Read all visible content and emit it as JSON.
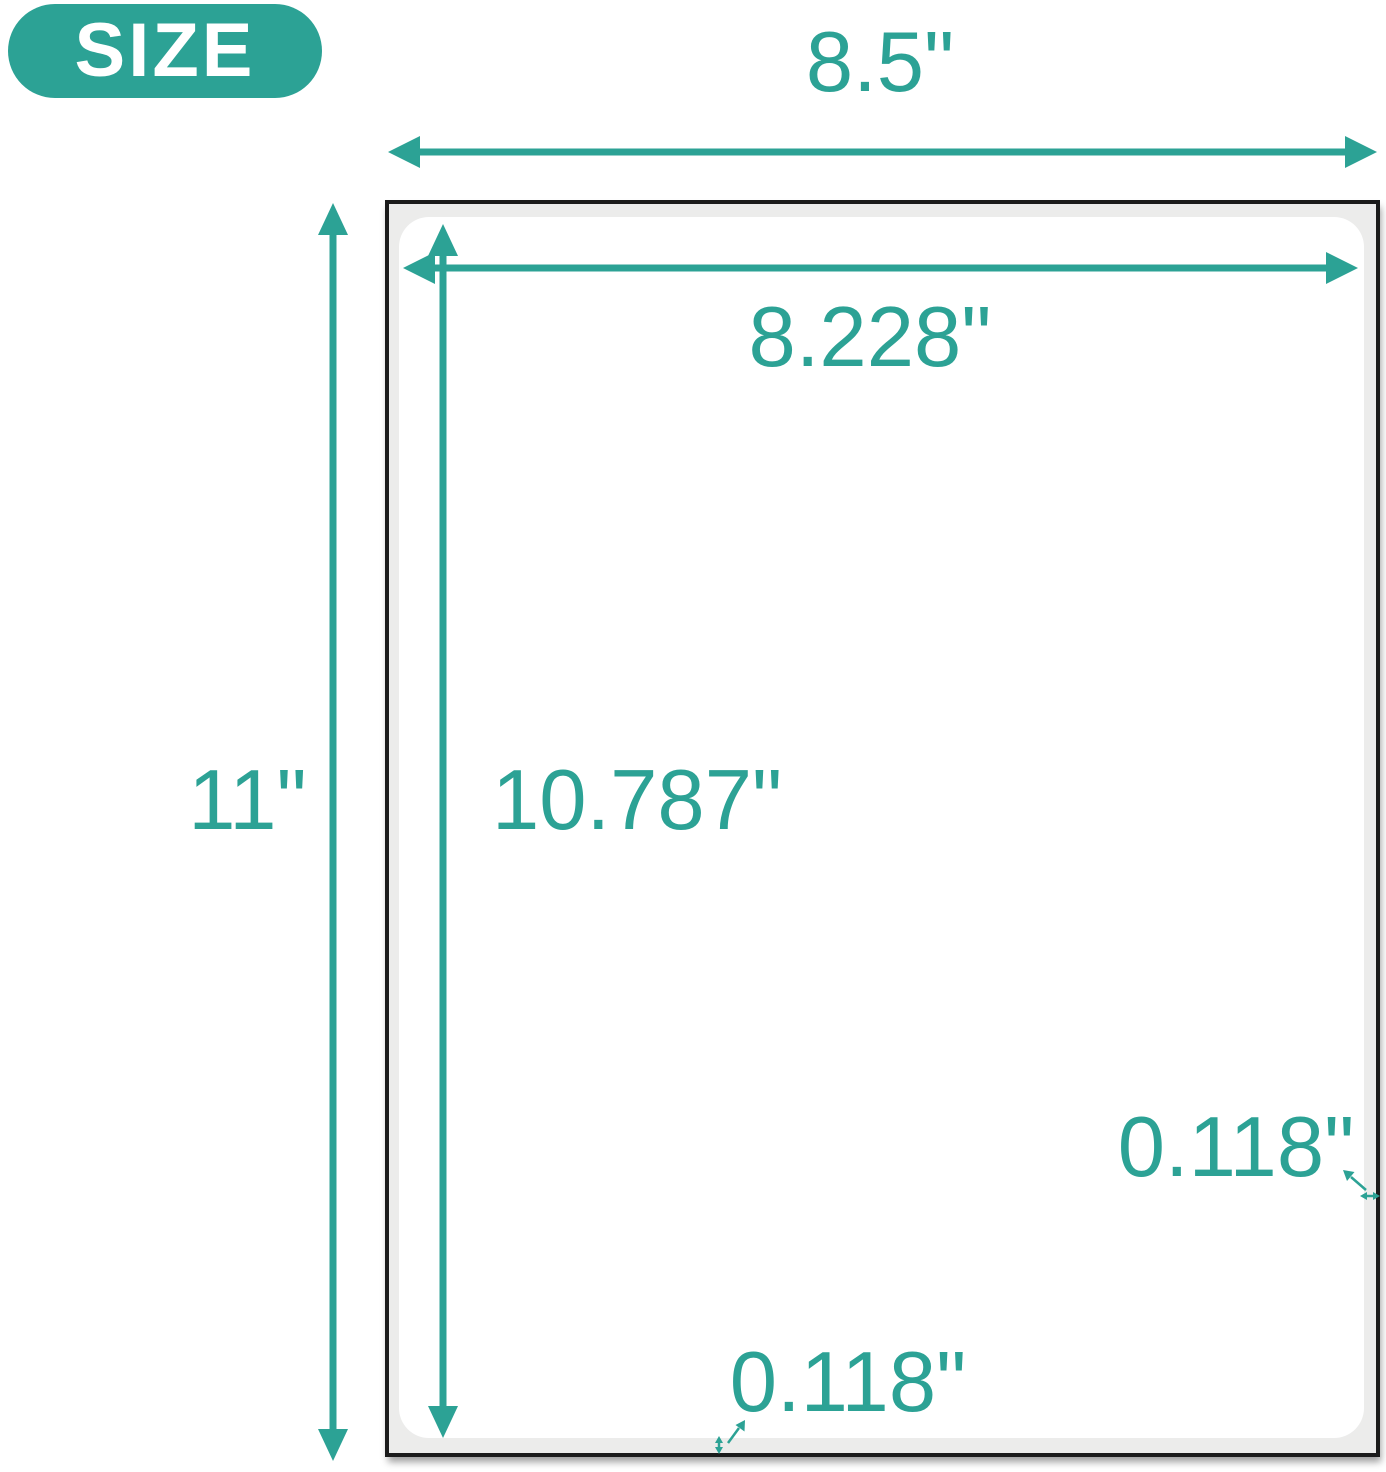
{
  "badge": {
    "label": "SIZE"
  },
  "dimensions": {
    "sheet_width": "8.5\"",
    "sheet_height": "11\"",
    "label_width": "8.228\"",
    "label_height": "10.787\"",
    "margin_right": "0.118\"",
    "margin_bottom": "0.118\""
  },
  "colors": {
    "accent": "#2CA295",
    "sheet_fill": "#ECECEB",
    "sheet_border": "#1B1B1B"
  }
}
